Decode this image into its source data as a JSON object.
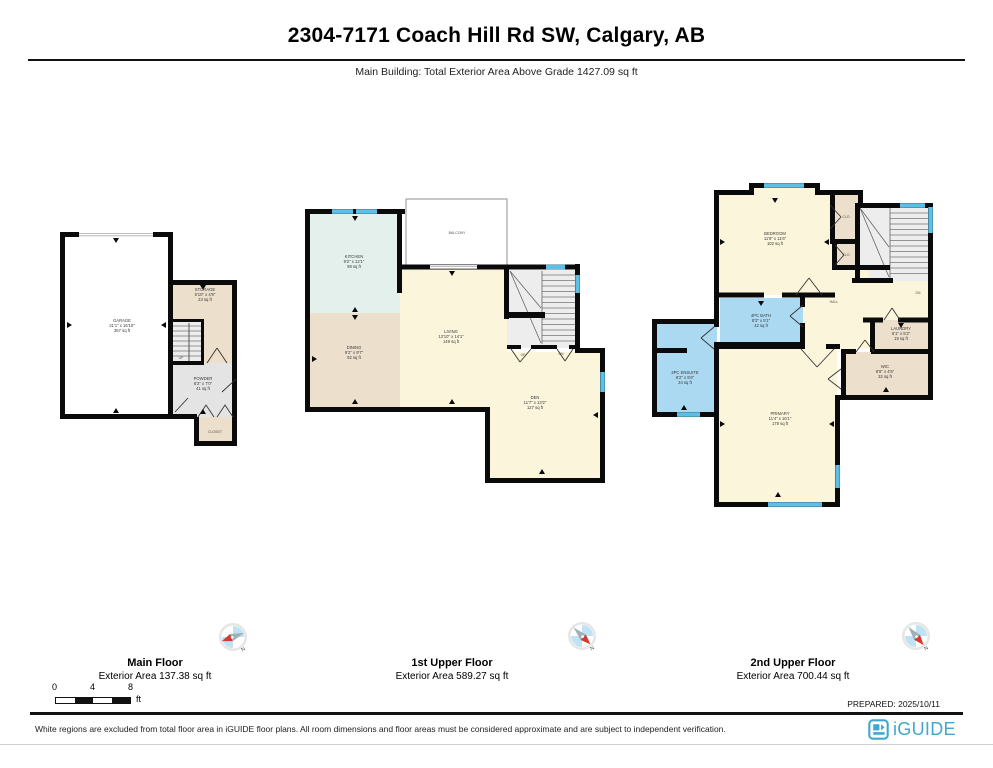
{
  "header": {
    "title": "2304-7171 Coach Hill Rd SW, Calgary, AB",
    "subtitle": "Main Building: Total Exterior Area Above Grade 1427.09 sq ft"
  },
  "floors": [
    {
      "name": "Main Floor",
      "area_label": "Exterior Area 137.38 sq ft",
      "rooms": {
        "garage": {
          "label": "GARAGE",
          "dims": "21'1\" x 16'10\"",
          "area": "357 sq ft"
        },
        "storage": {
          "label": "STORAGE",
          "dims": "6'10\" x 4'9\"",
          "area": "23 sq ft"
        },
        "powder": {
          "label": "POWDER",
          "dims": "6'2\" x 7'0\"",
          "area": "41 sq ft"
        },
        "closet": {
          "label": "CLOSET"
        },
        "stairs_up": {
          "label": "UP"
        }
      }
    },
    {
      "name": "1st Upper Floor",
      "area_label": "Exterior Area 589.27 sq ft",
      "rooms": {
        "balcony": {
          "label": "BALCONY"
        },
        "kitchen": {
          "label": "KITCHEN",
          "dims": "9'2\" x 12'1\"",
          "area": "98 sq ft"
        },
        "dining": {
          "label": "DINING",
          "dims": "9'2\" x 9'7\"",
          "area": "92 sq ft"
        },
        "living": {
          "label": "LIVING",
          "dims": "13'10\" x 14'1\"",
          "area": "149 sq ft"
        },
        "den": {
          "label": "DEN",
          "dims": "11'7\" x 13'2\"",
          "area": "127 sq ft"
        },
        "stairs_up": {
          "label": "UP"
        },
        "stairs_dn": {
          "label": "DN"
        }
      }
    },
    {
      "name": "2nd Upper Floor",
      "area_label": "Exterior Area 700.44 sq ft",
      "rooms": {
        "bedroom": {
          "label": "BEDROOM",
          "dims": "11'8\" x 11'6\"",
          "area": "102 sq ft"
        },
        "closet1": {
          "label": "CLO"
        },
        "closet2": {
          "label": "CLO"
        },
        "hall": {
          "label": "HALL"
        },
        "bath": {
          "label": "4PC BATH",
          "dims": "8'3\" x 5'1\"",
          "area": "42 sq ft"
        },
        "ensuite": {
          "label": "3PC ENSUITE",
          "dims": "8'2\" x 5'6\"",
          "area": "34 sq ft"
        },
        "laundry": {
          "label": "LAUNDRY",
          "dims": "6'1\" x 5'2\"",
          "area": "19 sq ft"
        },
        "wic": {
          "label": "WIC",
          "dims": "8'8\" x 4'5\"",
          "area": "32 sq ft"
        },
        "primary": {
          "label": "PRIMARY",
          "dims": "11'4\" x 16'1\"",
          "area": "178 sq ft"
        },
        "stairs_dn": {
          "label": "DN"
        }
      }
    }
  ],
  "compass": {
    "icon": "compass-rose-icon",
    "north_label": "N"
  },
  "scale_bar": {
    "ticks": [
      "0",
      "4",
      "8"
    ],
    "unit": "ft"
  },
  "prepared_label": "PREPARED: 2025/10/11",
  "footer": {
    "disclaimer": "White regions are excluded from total floor area in iGUIDE floor plans. All room dimensions and floor areas must be considered approximate and are subject to independent verification.",
    "brand": "iGUIDE"
  },
  "colors": {
    "wall": "#0a0a0a",
    "window_blue": "#5EBEE6",
    "room_cream": "#FBF5DB",
    "room_beige": "#ECDFCB",
    "room_teal": "#E3F0EB",
    "room_bath_blue": "#ABD9F2",
    "room_gray": "#E4E4E4",
    "stair_gray": "#EDEDED",
    "brand_teal": "#3FA8CE",
    "compass_red": "#D43B30"
  }
}
